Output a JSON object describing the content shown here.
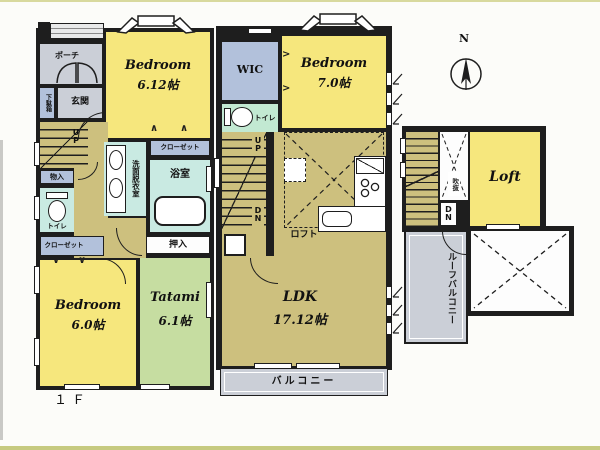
{
  "colors": {
    "wall": "#1e1e1e",
    "bedroom_yellow": "#f6e77d",
    "hall_tan": "#cdc07e",
    "tatami_green": "#c6dda1",
    "wet_cyan": "#c9eae2",
    "toilet_mint": "#c2e9d2",
    "closet_bluegray": "#b2c1db",
    "balcony_gray": "#cbcfd7"
  },
  "compass": {
    "north_label": "N"
  },
  "floor1": {
    "floor_label": "１Ｆ",
    "porch": "ポーチ",
    "shoe_cabinet": "下駄箱",
    "entrance": "玄関",
    "up": "UP",
    "storage": "物入",
    "toilet": "トイレ",
    "closet_side": "クローゼット",
    "washroom": "洗面脱衣室",
    "closet_top": "クローゼット",
    "bath": "浴室",
    "oshiire": "押入",
    "bedroom_a": {
      "name": "Bedroom",
      "size": "6.12帖"
    },
    "bedroom_b": {
      "name": "Bedroom",
      "size": "6.0帖"
    },
    "tatami": {
      "name": "Tatami",
      "size": "6.1帖"
    }
  },
  "floor2": {
    "wic": "WIC",
    "toilet": "トイレ",
    "bedroom": {
      "name": "Bedroom",
      "size": "7.0帖"
    },
    "up": "UP",
    "dn": "DN",
    "fridge": "冷",
    "washer": "洗",
    "loft_mark": "ロフト",
    "ldk": {
      "name": "LDK",
      "size": "17.12帖"
    },
    "balcony": "バルコニー"
  },
  "loft_floor": {
    "void": "吹抜",
    "dn": "DN",
    "room_name": "Loft",
    "roof_balcony_col_right": "ルーフ",
    "roof_balcony_col_left": "バルコニー"
  }
}
